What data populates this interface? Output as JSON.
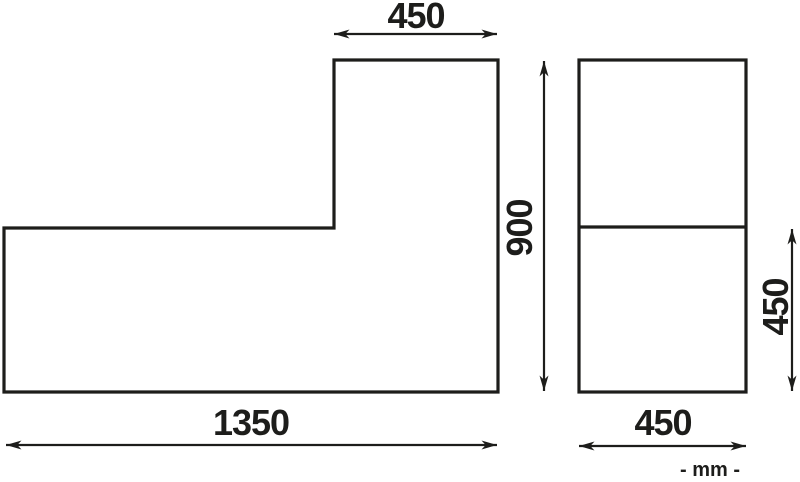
{
  "drawing": {
    "background_color": "#ffffff",
    "line_color": "#1d1d1b",
    "units_label": "- mm -",
    "l_shape_figure": {
      "top_width_label": "450",
      "height_label": "900",
      "bottom_width_label": "1350"
    },
    "side_panel_figure": {
      "width_label": "450",
      "half_height_label": "450"
    }
  }
}
